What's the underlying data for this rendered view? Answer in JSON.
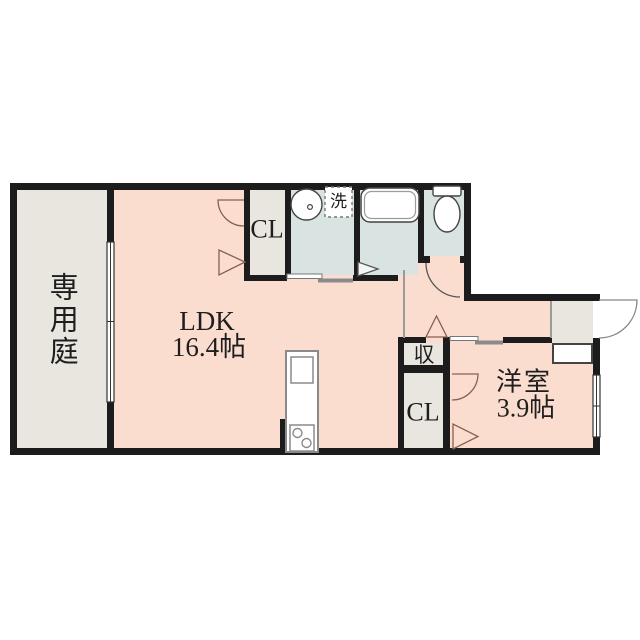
{
  "floorplan": {
    "title": "1LDK floor plan",
    "rooms": {
      "garden": {
        "label": "専用庭"
      },
      "ldk": {
        "label": "LDK",
        "size": "16.4帖"
      },
      "closet_top": {
        "label": "CL"
      },
      "laundry": {
        "label": "洗"
      },
      "storage": {
        "label": "収"
      },
      "closet_bottom": {
        "label": "CL"
      },
      "western_room": {
        "label": "洋室",
        "size": "3.9帖"
      }
    },
    "fixtures": {
      "sink": "washbasin-icon",
      "washer_pan": "washing-machine-icon",
      "bathtub": "bathtub-icon",
      "toilet": "toilet-icon",
      "kitchen": "kitchen-counter-icon",
      "stove": "stove-icon",
      "entry_door": "door-swing-icon",
      "windows": "sliding-window-icon"
    },
    "colors": {
      "wall": "#1c1c1c",
      "room_pink": "#fbddcf",
      "room_gray": "#e8e6df",
      "room_blue": "#d9e4e2",
      "fixture_stroke": "#444444",
      "slider_gray": "#8a8a8a"
    }
  }
}
